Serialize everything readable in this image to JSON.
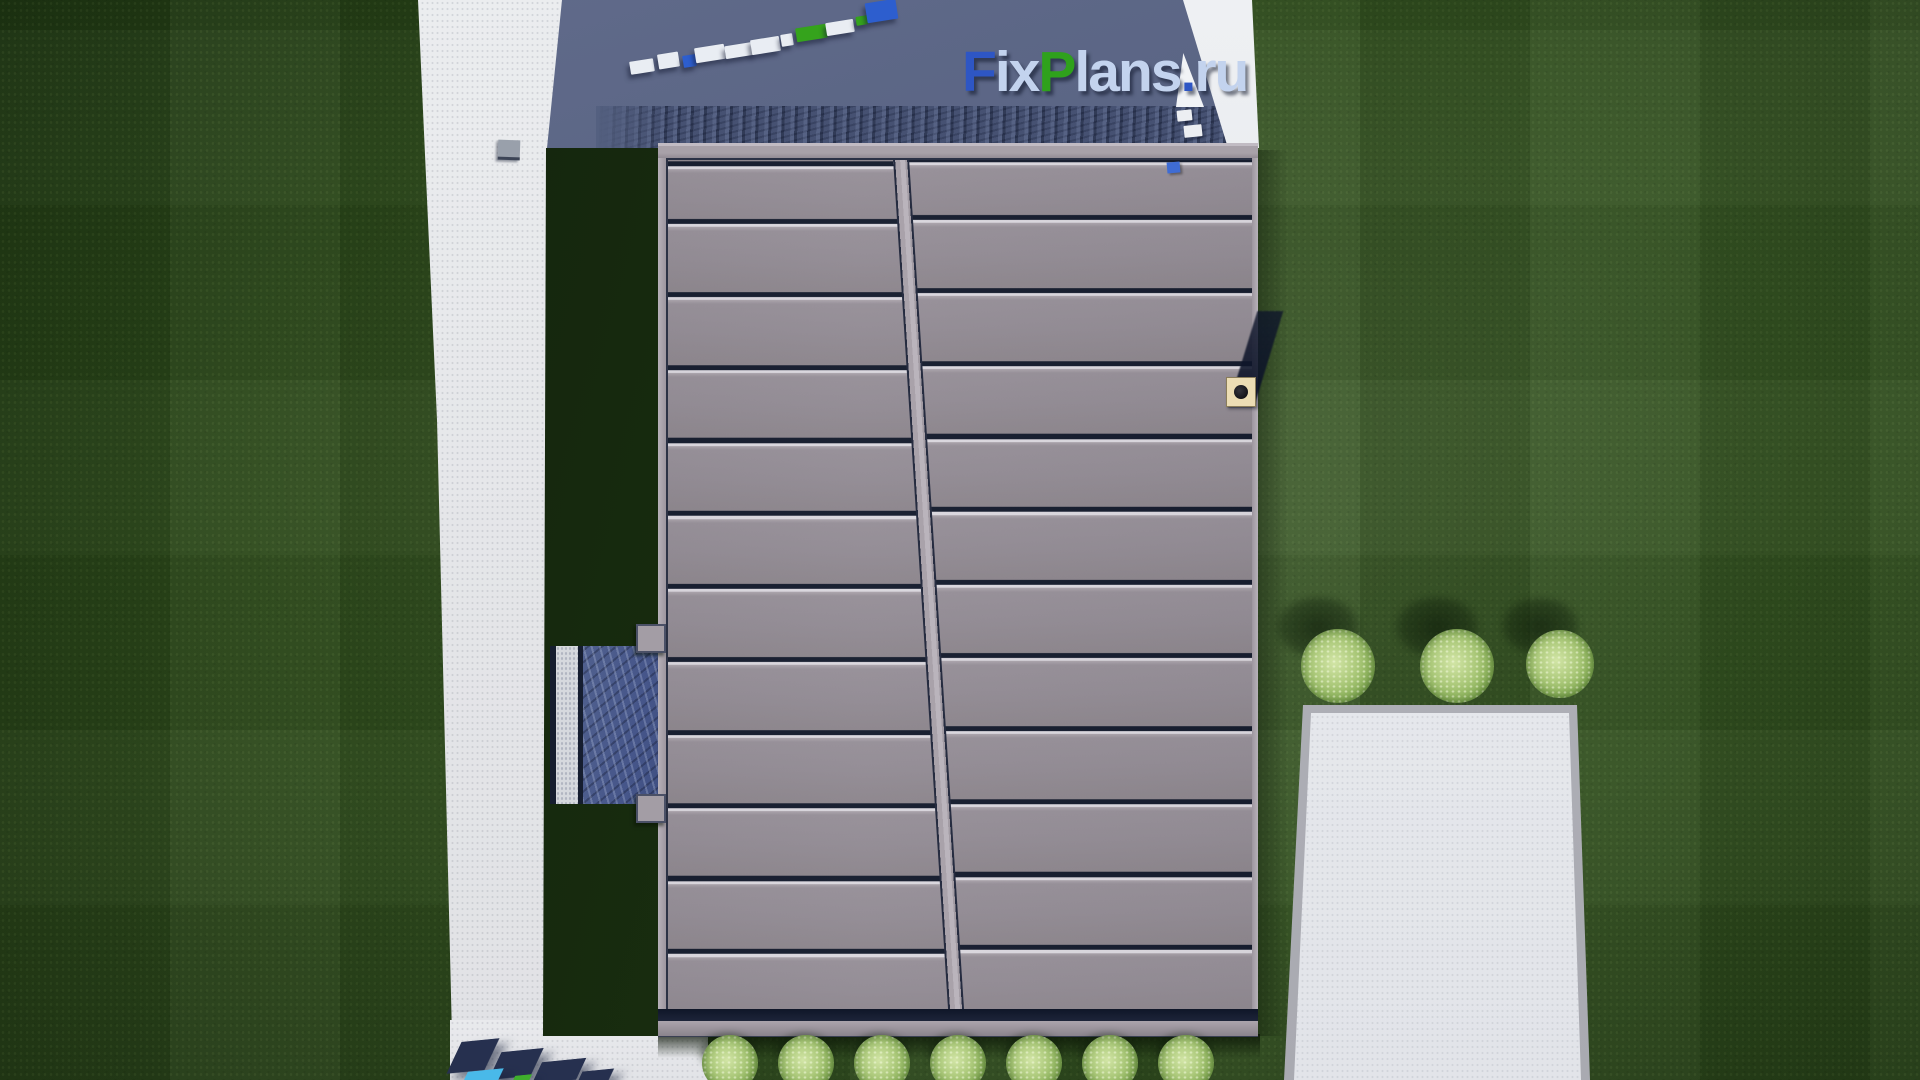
{
  "watermark_logo": {
    "full_text": "FixPlans.ru",
    "segments": [
      {
        "text": "F",
        "color": "#2e56c4"
      },
      {
        "text": "ix",
        "color": "#c3d3ee"
      },
      {
        "text": "P",
        "color": "#2fa11c"
      },
      {
        "text": "lans",
        "color": "#c3d3ee"
      },
      {
        "text": ".",
        "color": "#2e56c4"
      },
      {
        "text": "ru",
        "color": "#c3d3ee"
      }
    ]
  },
  "scene": {
    "description_of_view": "top-down aerial render of a house roof",
    "palette": {
      "grass_base": "#2e4b1c",
      "grass_shadow": "#16270e",
      "roof_panel_gray": "#8e8791",
      "roof_seam_dark": "#0f1628",
      "roof_seam_highlight": "#d9d6dd",
      "driveway_slate": "#566180",
      "stone_band_navy": "#3e4966",
      "path_white": "#e6e7e9",
      "patio_white": "#ecedf0",
      "patio_border_gray": "#b4b5bc",
      "walkway_blue": "#46568a",
      "chimney_beige": "#ecddb4",
      "bush_green": "#a3c470",
      "watermark_blue": "#2d5ece",
      "watermark_green": "#35a31c",
      "watermark_cyan": "#49b9e9"
    },
    "counts": {
      "roof_panel_rows_left": 12,
      "roof_panel_rows_right": 12,
      "bushes_right_of_house": 3,
      "bushes_below_house": 7
    }
  }
}
